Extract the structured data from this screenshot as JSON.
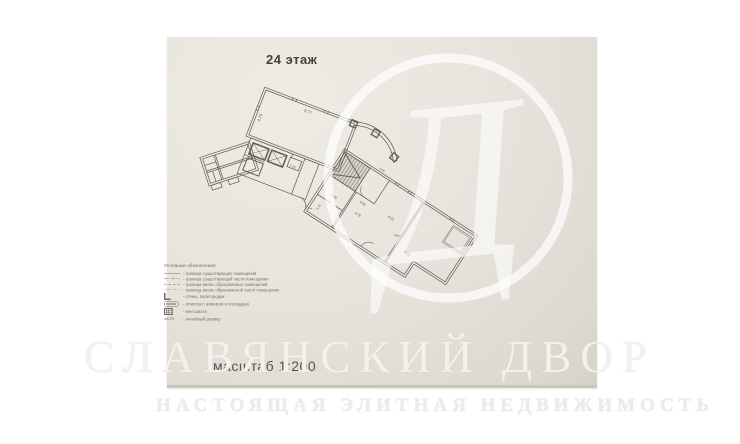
{
  "photo": {
    "floor_label": "24 этаж",
    "scale_label": "масштаб 1:200"
  },
  "plan": {
    "dims": {
      "room_a_top": "9.77",
      "room_a_left": "4.70",
      "core": "7.23",
      "lobby": "2.06",
      "r1_width": "3.68",
      "r1_depth": "2.13",
      "r2_width": "4.96",
      "r2_inner": "4.76",
      "r2_side": "4.91",
      "r3_bottom": "4.90"
    }
  },
  "legend": {
    "title": "Условные обозначения",
    "items": [
      {
        "icon": "line-solid",
        "label": "граница существующих помещений"
      },
      {
        "icon": "line-dashdot",
        "label": "граница существующей части помещения"
      },
      {
        "icon": "line-dashed",
        "label": "граница вновь образованных помещений"
      },
      {
        "icon": "line-dotted",
        "label": "граница вновь образованной части помещения"
      },
      {
        "icon": "wall-corner",
        "label": "стены, перегородки"
      },
      {
        "icon": "oval-stamp",
        "label": "отметка с номером и площадью"
      },
      {
        "icon": "vent-grid",
        "label": "вентшахта"
      },
      {
        "icon": "dim-sample",
        "label": "линейный размер",
        "sample": "18.29"
      }
    ]
  },
  "watermark": {
    "brand": "СЛАВЯНСКИЙ ДВОР",
    "tagline": "НАСТОЯЩАЯ ЭЛИТНАЯ НЕДВИЖИМОСТЬ",
    "monogram": "Д"
  }
}
